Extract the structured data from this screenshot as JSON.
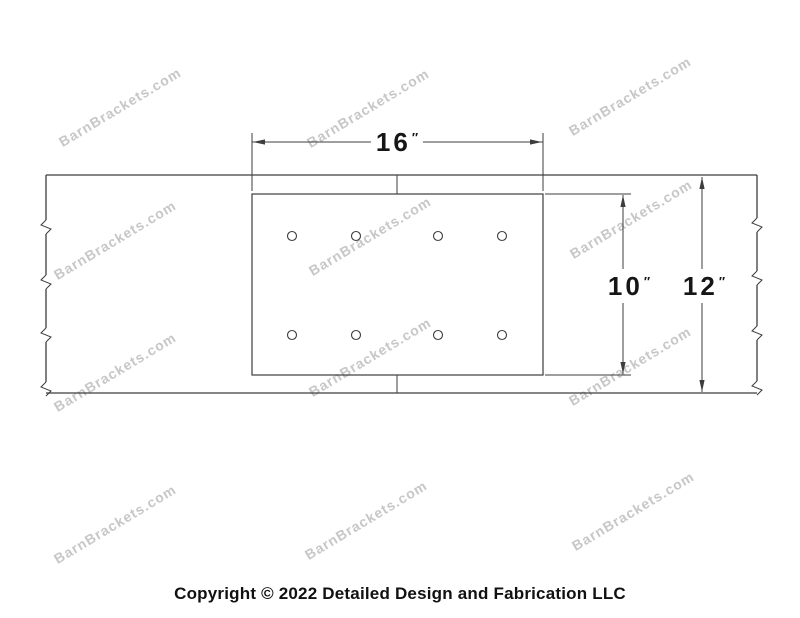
{
  "watermark": {
    "text": "BarnBrackets.com",
    "color": "#c7c7c7",
    "angle_deg": -31,
    "positions": [
      {
        "x": 120,
        "y": 107
      },
      {
        "x": 368,
        "y": 108
      },
      {
        "x": 630,
        "y": 96
      },
      {
        "x": 115,
        "y": 240
      },
      {
        "x": 370,
        "y": 236
      },
      {
        "x": 631,
        "y": 219
      },
      {
        "x": 115,
        "y": 372
      },
      {
        "x": 370,
        "y": 357
      },
      {
        "x": 630,
        "y": 366
      },
      {
        "x": 115,
        "y": 524
      },
      {
        "x": 366,
        "y": 520
      },
      {
        "x": 633,
        "y": 511
      }
    ]
  },
  "dimensions": {
    "width_label": {
      "value": "16",
      "unit": "″"
    },
    "plate_height_label": {
      "value": "10",
      "unit": "″"
    },
    "beam_height_label": {
      "value": "12",
      "unit": "″"
    }
  },
  "footer": {
    "copyright": "Copyright © 2022 Detailed Design and Fabrication LLC"
  },
  "drawing": {
    "line_color": "#3d3d3d",
    "beam": {
      "x1": 46,
      "y1": 175,
      "x2": 757,
      "y2": 393
    },
    "plate": {
      "x": 252,
      "y": 194,
      "w": 291,
      "h": 181
    },
    "holes": {
      "r": 4.5,
      "xs": [
        292,
        356,
        438,
        502
      ],
      "rows": [
        236,
        335
      ]
    },
    "seam_x": 397,
    "breaks": {
      "left": [
        227,
        282,
        335,
        389
      ],
      "right": [
        225,
        278,
        333,
        388
      ]
    },
    "dim_width": {
      "y": 142,
      "x1": 252,
      "x2": 543,
      "ext_top": 133,
      "ext_bottom": 191
    },
    "dim_plate": {
      "x": 623,
      "y1": 195,
      "y2": 374,
      "ext_x1": 545,
      "ext_x2": 631,
      "ext_y_top": 194,
      "ext_y_bottom": 375
    },
    "dim_beam": {
      "x": 702,
      "y1": 177,
      "y2": 392
    }
  }
}
